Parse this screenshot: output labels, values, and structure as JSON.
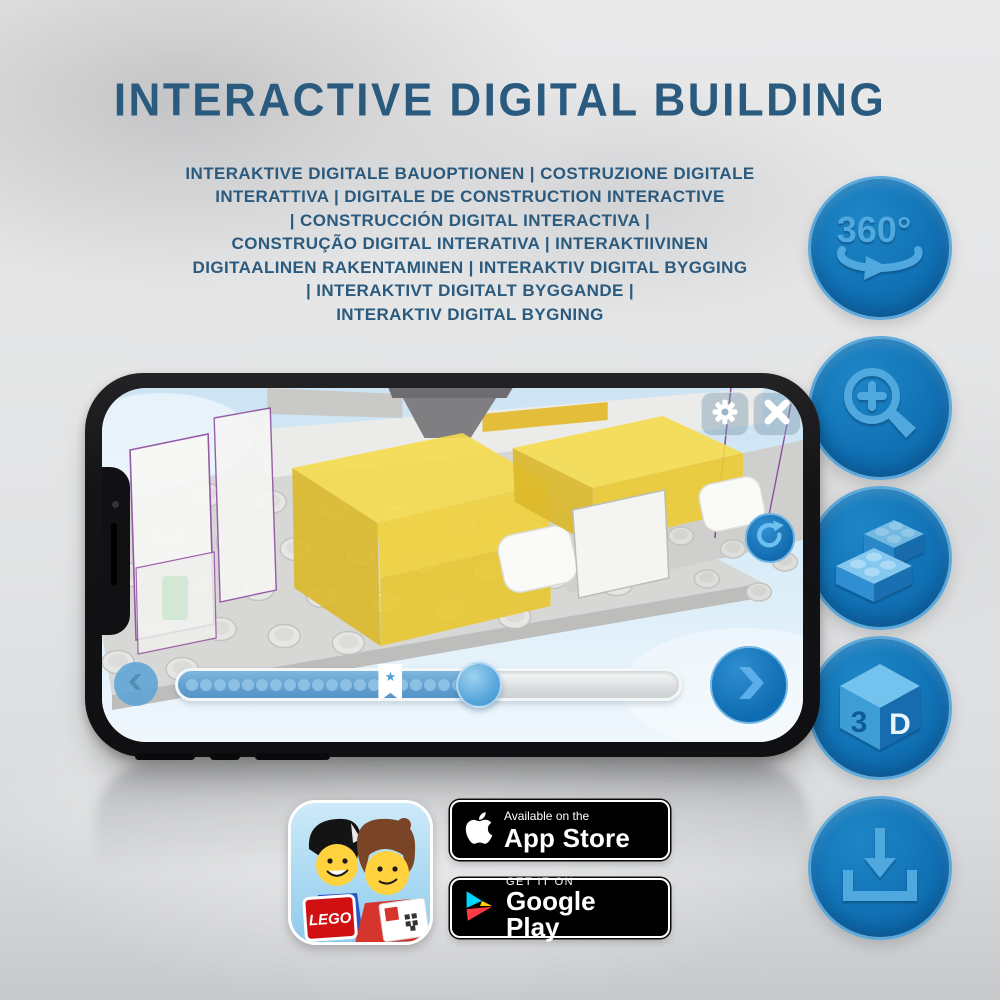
{
  "header": {
    "title": "INTERACTIVE DIGITAL BUILDING"
  },
  "subtitle": {
    "lines": [
      "INTERAKTIVE DIGITALE BAUOPTIONEN | COSTRUZIONE DIGITALE",
      "INTERATTIVA | DIGITALE DE CONSTRUCTION INTERACTIVE",
      "| CONSTRUCCIÓN DIGITAL INTERACTIVA |",
      "CONSTRUÇÃO DIGITAL INTERATIVA | INTERAKTIIVINEN",
      "DIGITAALINEN RAKENTAMINEN | INTERAKTIV DIGITAL BYGGING",
      "| INTERAKTIVT DIGITALT BYGGANDE |",
      "INTERAKTIV DIGITAL BYGNING"
    ]
  },
  "features": {
    "rotate360": {
      "label": "360°"
    },
    "cube3d": {
      "face_left": "3",
      "face_right": "D"
    },
    "icon_names": [
      "360-rotation-icon",
      "zoom-in-icon",
      "lego-bricks-icon",
      "3d-cube-icon",
      "download-icon"
    ]
  },
  "phone": {
    "progress": {
      "fill_percent": 60,
      "bookmark_percent": 40,
      "dot_count": 21,
      "bookmark_star": "★"
    }
  },
  "footer": {
    "app_icon_brand": "LEGO",
    "app_store": {
      "line1": "Available on the",
      "line2": "App Store"
    },
    "google_play": {
      "line1": "GET IT ON",
      "line2": "Google Play"
    }
  },
  "colors": {
    "title_blue": "#2a5a7e",
    "circle_blue": "#1173b6",
    "icon_light_blue": "#4fa8de",
    "progress_fill_blue": "#5f9fd0",
    "brick_yellow": "#f2d64a",
    "outline_purple": "#8f4fa0",
    "badge_black": "#000000"
  }
}
